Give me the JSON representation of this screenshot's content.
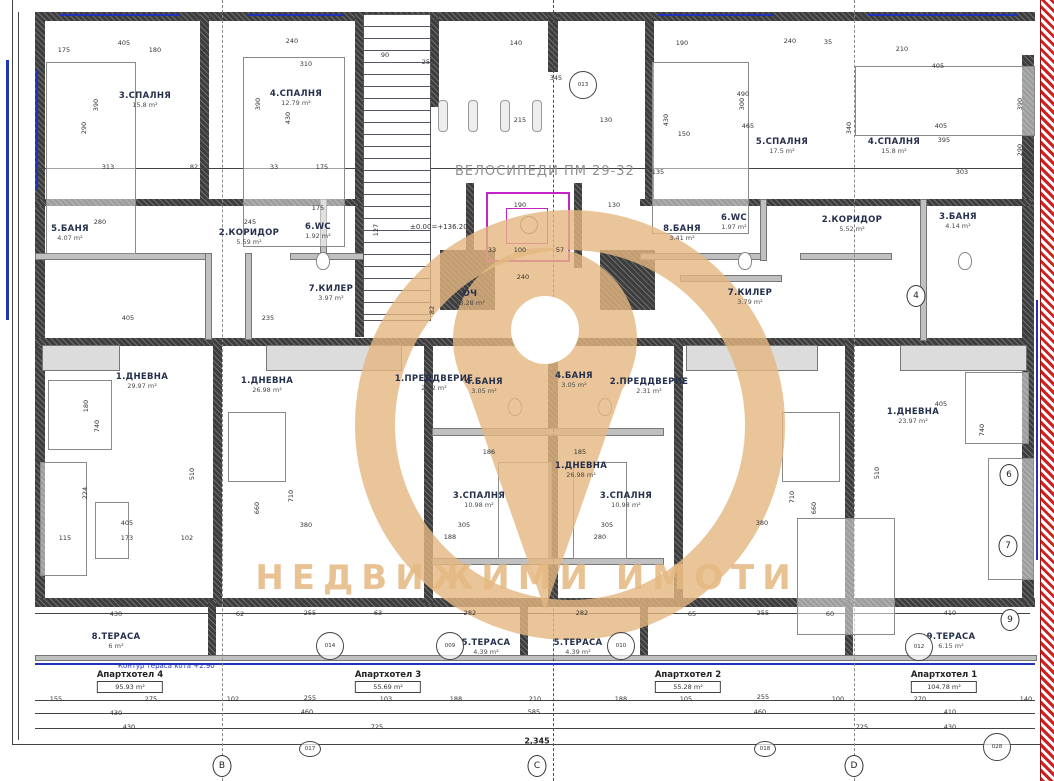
{
  "watermark": {
    "brand_text": "НЕДВИЖИМИ ИМОТИ",
    "color": "#e4b780"
  },
  "labels": {
    "bike": "ВЕЛОСИПЕДИ ПМ 29-32",
    "elevation": "±0.00=+136.20",
    "terrace_contour": "Контур тераса кота +2.90",
    "total_dim": "2,345"
  },
  "rooms": [
    {
      "label": "3.СПАЛНЯ",
      "area": "15.8 m²",
      "x": 145,
      "y": 100
    },
    {
      "label": "4.СПАЛНЯ",
      "area": "12.79 m²",
      "x": 296,
      "y": 98
    },
    {
      "label": "5.БАНЯ",
      "area": "4.07 m²",
      "x": 70,
      "y": 233
    },
    {
      "label": "2.КОРИДОР",
      "area": "5.59 m²",
      "x": 249,
      "y": 237
    },
    {
      "label": "6.WC",
      "area": "1.92 m²",
      "x": 318,
      "y": 231
    },
    {
      "label": "7.КИЛЕР",
      "area": "3.97 m²",
      "x": 331,
      "y": 293
    },
    {
      "label": "1.ДНЕВНА",
      "area": "29.97 m²",
      "x": 142,
      "y": 381
    },
    {
      "label": "8.ТЕРАСА",
      "area": "6 m²",
      "x": 116,
      "y": 641
    },
    {
      "label": "1.ДНЕВНА",
      "area": "26.98 m²",
      "x": 267,
      "y": 385
    },
    {
      "label": "1.ПРЕДДВЕРИЕ",
      "area": "2.32 m²",
      "x": 434,
      "y": 383
    },
    {
      "label": "4.БАНЯ",
      "area": "3.05 m²",
      "x": 484,
      "y": 386
    },
    {
      "label": "3.СПАЛНЯ",
      "area": "10.98 m²",
      "x": 479,
      "y": 500
    },
    {
      "label": "5.ТЕРАСА",
      "area": "4.39 m²",
      "x": 486,
      "y": 647
    },
    {
      "label": "4.БАНЯ",
      "area": "3.05 m²",
      "x": 574,
      "y": 380
    },
    {
      "label": "2.ПРЕДДВЕРИЕ",
      "area": "2.31 m²",
      "x": 649,
      "y": 386
    },
    {
      "label": "3.СПАЛНЯ",
      "area": "10.98 m²",
      "x": 626,
      "y": 500
    },
    {
      "label": "5.ТЕРАСА",
      "area": "4.39 m²",
      "x": 578,
      "y": 647
    },
    {
      "label": "1.ДНЕВНА",
      "area": "26.98 m²",
      "x": 581,
      "y": 470
    },
    {
      "label": "5.СПАЛНЯ",
      "area": "17.5 m²",
      "x": 782,
      "y": 146
    },
    {
      "label": "4.СПАЛНЯ",
      "area": "15.8 m²",
      "x": 894,
      "y": 146
    },
    {
      "label": "8.БАНЯ",
      "area": "3.41 m²",
      "x": 682,
      "y": 233
    },
    {
      "label": "6.WC",
      "area": "1.97 m²",
      "x": 734,
      "y": 222
    },
    {
      "label": "2.КОРИДОР",
      "area": "5.52 m²",
      "x": 852,
      "y": 224
    },
    {
      "label": "3.БАНЯ",
      "area": "4.14 m²",
      "x": 958,
      "y": 221
    },
    {
      "label": "7.КИЛЕР",
      "area": "3.79 m²",
      "x": 750,
      "y": 297
    },
    {
      "label": "1.ДНЕВНА",
      "area": "23.97 m²",
      "x": 913,
      "y": 416
    },
    {
      "label": "9.ТЕРАСА",
      "area": "6.15 m²",
      "x": 951,
      "y": 641
    },
    {
      "label": "ОЧ",
      "area": "48.28 m²",
      "x": 470,
      "y": 298
    }
  ],
  "apartments": [
    {
      "label": "Апартхотел 4",
      "area": "95.93 m²",
      "x": 130,
      "y": 670
    },
    {
      "label": "Апартхотел 3",
      "area": "55.69 m²",
      "x": 388,
      "y": 670
    },
    {
      "label": "Апартхотел 2",
      "area": "55.28 m²",
      "x": 688,
      "y": 670
    },
    {
      "label": "Апартхотел 1",
      "area": "104.78 m²",
      "x": 944,
      "y": 670
    }
  ],
  "grid_markers": {
    "bottom": [
      {
        "label": "B",
        "x": 222,
        "y": 766
      },
      {
        "label": "C",
        "x": 537,
        "y": 766
      },
      {
        "label": "D",
        "x": 854,
        "y": 766
      }
    ],
    "right": [
      {
        "label": "4",
        "x": 916,
        "y": 296
      },
      {
        "label": "6",
        "x": 1009,
        "y": 475
      },
      {
        "label": "7",
        "x": 1008,
        "y": 546
      },
      {
        "label": "9",
        "x": 1010,
        "y": 620
      }
    ]
  },
  "detail_marks": [
    {
      "label": "013",
      "x": 583,
      "y": 85
    },
    {
      "label": "014",
      "x": 330,
      "y": 646
    },
    {
      "label": "009",
      "x": 450,
      "y": 646
    },
    {
      "label": "010",
      "x": 621,
      "y": 646
    },
    {
      "label": "012",
      "x": 919,
      "y": 647
    },
    {
      "label": "017",
      "x": 310,
      "y": 749,
      "small": true
    },
    {
      "label": "018",
      "x": 765,
      "y": 749,
      "small": true
    },
    {
      "label": "028",
      "x": 997,
      "y": 747
    }
  ],
  "dimensions": [
    {
      "t": "175",
      "x": 64,
      "y": 50
    },
    {
      "t": "405",
      "x": 124,
      "y": 43
    },
    {
      "t": "180",
      "x": 155,
      "y": 50
    },
    {
      "t": "50",
      "x": 205,
      "y": 50
    },
    {
      "t": "240",
      "x": 292,
      "y": 41
    },
    {
      "t": "310",
      "x": 306,
      "y": 64
    },
    {
      "t": "90",
      "x": 385,
      "y": 55
    },
    {
      "t": "250",
      "x": 428,
      "y": 62
    },
    {
      "t": "140",
      "x": 516,
      "y": 43
    },
    {
      "t": "345",
      "x": 556,
      "y": 78
    },
    {
      "t": "215",
      "x": 520,
      "y": 120
    },
    {
      "t": "130",
      "x": 606,
      "y": 120
    },
    {
      "t": "190",
      "x": 682,
      "y": 43
    },
    {
      "t": "240",
      "x": 790,
      "y": 41
    },
    {
      "t": "35",
      "x": 828,
      "y": 42
    },
    {
      "t": "210",
      "x": 902,
      "y": 49
    },
    {
      "t": "405",
      "x": 938,
      "y": 66
    },
    {
      "t": "490",
      "x": 743,
      "y": 94
    },
    {
      "t": "465",
      "x": 748,
      "y": 126
    },
    {
      "t": "150",
      "x": 684,
      "y": 134
    },
    {
      "t": "405",
      "x": 941,
      "y": 126
    },
    {
      "t": "395",
      "x": 944,
      "y": 140
    },
    {
      "t": "390",
      "x": 96,
      "y": 105,
      "r": 1
    },
    {
      "t": "290",
      "x": 84,
      "y": 128,
      "r": 1
    },
    {
      "t": "390",
      "x": 258,
      "y": 104,
      "r": 1
    },
    {
      "t": "430",
      "x": 288,
      "y": 118,
      "r": 1
    },
    {
      "t": "300",
      "x": 742,
      "y": 104,
      "r": 1
    },
    {
      "t": "340",
      "x": 849,
      "y": 128,
      "r": 1
    },
    {
      "t": "390",
      "x": 1020,
      "y": 104,
      "r": 1
    },
    {
      "t": "290",
      "x": 1020,
      "y": 150,
      "r": 1
    },
    {
      "t": "430",
      "x": 666,
      "y": 120,
      "r": 1
    },
    {
      "t": "313",
      "x": 108,
      "y": 167
    },
    {
      "t": "82",
      "x": 194,
      "y": 167
    },
    {
      "t": "33",
      "x": 274,
      "y": 167
    },
    {
      "t": "175",
      "x": 322,
      "y": 167
    },
    {
      "t": "135",
      "x": 658,
      "y": 172
    },
    {
      "t": "303",
      "x": 962,
      "y": 172
    },
    {
      "t": "280",
      "x": 100,
      "y": 222
    },
    {
      "t": "245",
      "x": 250,
      "y": 222
    },
    {
      "t": "175",
      "x": 318,
      "y": 208
    },
    {
      "t": "190",
      "x": 520,
      "y": 205
    },
    {
      "t": "130",
      "x": 614,
      "y": 205
    },
    {
      "t": "127",
      "x": 376,
      "y": 230,
      "r": 1
    },
    {
      "t": "33",
      "x": 492,
      "y": 250
    },
    {
      "t": "100",
      "x": 520,
      "y": 250
    },
    {
      "t": "57",
      "x": 560,
      "y": 250
    },
    {
      "t": "240",
      "x": 523,
      "y": 277
    },
    {
      "t": "82",
      "x": 432,
      "y": 310,
      "r": 1
    },
    {
      "t": "235",
      "x": 268,
      "y": 318
    },
    {
      "t": "405",
      "x": 128,
      "y": 318
    },
    {
      "t": "405",
      "x": 127,
      "y": 523
    },
    {
      "t": "380",
      "x": 306,
      "y": 525
    },
    {
      "t": "380",
      "x": 762,
      "y": 523
    },
    {
      "t": "405",
      "x": 941,
      "y": 404
    },
    {
      "t": "510",
      "x": 192,
      "y": 474,
      "r": 1
    },
    {
      "t": "740",
      "x": 97,
      "y": 426,
      "r": 1
    },
    {
      "t": "224",
      "x": 85,
      "y": 493,
      "r": 1
    },
    {
      "t": "180",
      "x": 86,
      "y": 406,
      "r": 1
    },
    {
      "t": "710",
      "x": 291,
      "y": 496,
      "r": 1
    },
    {
      "t": "660",
      "x": 257,
      "y": 508,
      "r": 1
    },
    {
      "t": "510",
      "x": 877,
      "y": 473,
      "r": 1
    },
    {
      "t": "740",
      "x": 982,
      "y": 430,
      "r": 1
    },
    {
      "t": "710",
      "x": 792,
      "y": 497,
      "r": 1
    },
    {
      "t": "660",
      "x": 814,
      "y": 508,
      "r": 1
    },
    {
      "t": "186",
      "x": 489,
      "y": 452
    },
    {
      "t": "185",
      "x": 580,
      "y": 452
    },
    {
      "t": "305",
      "x": 464,
      "y": 525
    },
    {
      "t": "305",
      "x": 607,
      "y": 525
    },
    {
      "t": "188",
      "x": 450,
      "y": 537
    },
    {
      "t": "280",
      "x": 600,
      "y": 537
    },
    {
      "t": "115",
      "x": 65,
      "y": 538
    },
    {
      "t": "173",
      "x": 127,
      "y": 538
    },
    {
      "t": "102",
      "x": 187,
      "y": 538
    },
    {
      "t": "430",
      "x": 116,
      "y": 614
    },
    {
      "t": "62",
      "x": 240,
      "y": 614
    },
    {
      "t": "255",
      "x": 310,
      "y": 613
    },
    {
      "t": "63",
      "x": 378,
      "y": 613
    },
    {
      "t": "282",
      "x": 470,
      "y": 613
    },
    {
      "t": "282",
      "x": 582,
      "y": 613
    },
    {
      "t": "65",
      "x": 692,
      "y": 614
    },
    {
      "t": "255",
      "x": 763,
      "y": 613
    },
    {
      "t": "60",
      "x": 830,
      "y": 614
    },
    {
      "t": "410",
      "x": 950,
      "y": 613
    },
    {
      "t": "155",
      "x": 56,
      "y": 699
    },
    {
      "t": "275",
      "x": 151,
      "y": 699
    },
    {
      "t": "102",
      "x": 233,
      "y": 699
    },
    {
      "t": "255",
      "x": 310,
      "y": 698
    },
    {
      "t": "103",
      "x": 386,
      "y": 699
    },
    {
      "t": "188",
      "x": 456,
      "y": 699
    },
    {
      "t": "210",
      "x": 535,
      "y": 699
    },
    {
      "t": "188",
      "x": 621,
      "y": 699
    },
    {
      "t": "105",
      "x": 686,
      "y": 699
    },
    {
      "t": "255",
      "x": 763,
      "y": 697
    },
    {
      "t": "100",
      "x": 838,
      "y": 699
    },
    {
      "t": "270",
      "x": 920,
      "y": 699
    },
    {
      "t": "140",
      "x": 1026,
      "y": 699
    },
    {
      "t": "430",
      "x": 116,
      "y": 713
    },
    {
      "t": "460",
      "x": 307,
      "y": 712
    },
    {
      "t": "585",
      "x": 534,
      "y": 712
    },
    {
      "t": "460",
      "x": 760,
      "y": 712
    },
    {
      "t": "410",
      "x": 950,
      "y": 712
    },
    {
      "t": "430",
      "x": 129,
      "y": 727
    },
    {
      "t": "725",
      "x": 377,
      "y": 727
    },
    {
      "t": "725",
      "x": 862,
      "y": 727
    },
    {
      "t": "430",
      "x": 950,
      "y": 727
    }
  ]
}
